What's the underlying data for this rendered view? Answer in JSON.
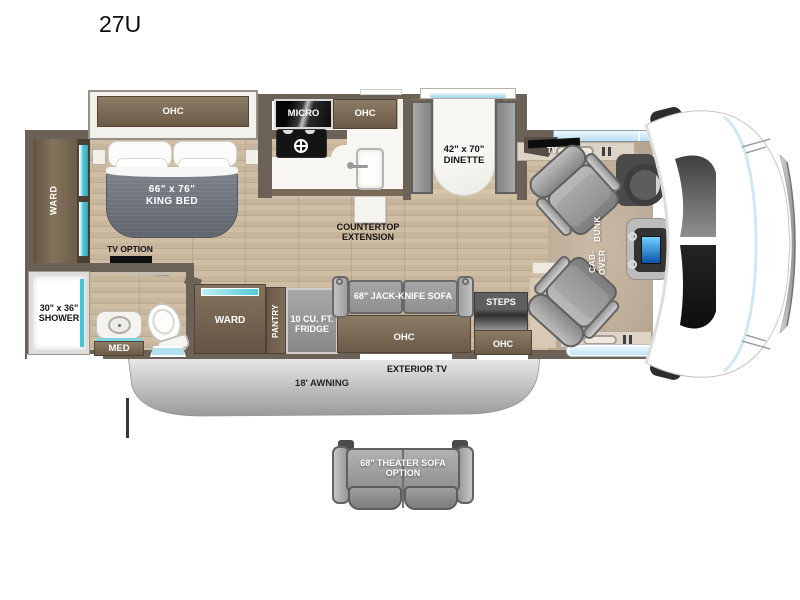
{
  "title": "27U",
  "bedroom": {
    "ohc": "OHC",
    "bed_size": "66\" x 76\"",
    "bed_name": "KING BED",
    "ward": "WARD",
    "tv_option": "TV OPTION"
  },
  "bathroom": {
    "shower_size": "30\" x 36\"",
    "shower_name": "SHOWER",
    "med": "MED"
  },
  "kitchen": {
    "micro": "MICRO",
    "ohc": "OHC",
    "countertop_line1": "COUNTERTOP",
    "countertop_line2": "EXTENSION"
  },
  "dinette": {
    "size": "42\" x 70\"",
    "name": "DINETTE"
  },
  "living": {
    "tv": "TV",
    "ward": "WARD",
    "pantry": "PANTRY",
    "fridge_line1": "10 CU. FT.",
    "fridge_line2": "FRIDGE",
    "sofa": "68\" JACK-KNIFE SOFA",
    "steps": "STEPS",
    "sofa_ohc": "OHC",
    "steps_ohc": "OHC"
  },
  "cab": {
    "bunk_line1": "CAB-OVER",
    "bunk_line2": "BUNK"
  },
  "exterior": {
    "tv": "EXTERIOR TV",
    "awning": "18' AWNING",
    "theater_line1": "68\" THEATER SOFA",
    "theater_line2": "OPTION"
  },
  "colors": {
    "wall": "#6B6156",
    "floor_wood": "#CDBBA2",
    "cabinet_brown": "#7B6A57",
    "teal_accent": "#4FC3D4",
    "window_blue": "#CFEAF8",
    "furniture_gray": "#9A9A9A",
    "bed_blanket": "#70747C",
    "awning_gray": "#B9B9B9",
    "micro_black": "#111111"
  }
}
